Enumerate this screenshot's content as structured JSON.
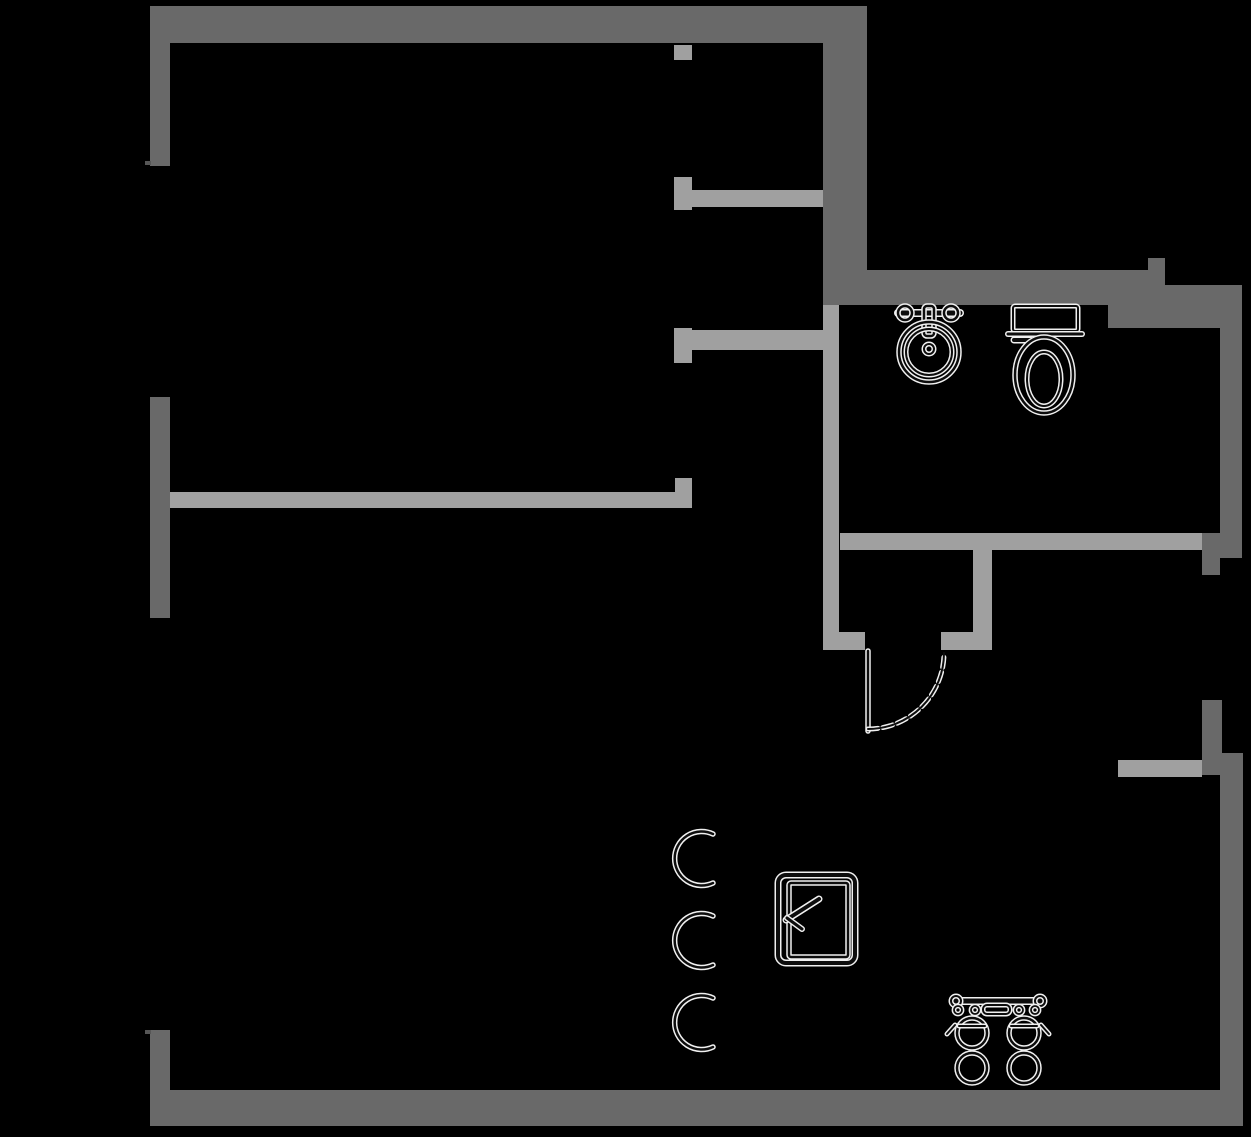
{
  "canvas": {
    "width": 1251,
    "height": 1137,
    "background": "#000000"
  },
  "colors": {
    "wall_dark": "#696969",
    "wall_light": "#a0a0a0",
    "tick": "#565656",
    "fixture_halo": "#f0f0f0",
    "fixture_core": "#0d0d0d"
  },
  "walls": {
    "dark": [
      {
        "name": "wall-top",
        "x": 152,
        "y": 6,
        "w": 715,
        "h": 37
      },
      {
        "name": "wall-left-upper",
        "x": 150,
        "y": 6,
        "w": 20,
        "h": 160
      },
      {
        "name": "wall-left-middle",
        "x": 150,
        "y": 397,
        "w": 20,
        "h": 221
      },
      {
        "name": "wall-left-lower",
        "x": 150,
        "y": 1030,
        "w": 20,
        "h": 96
      },
      {
        "name": "wall-bottom",
        "x": 150,
        "y": 1090,
        "w": 1093,
        "h": 36
      },
      {
        "name": "wall-divider-thick",
        "x": 823,
        "y": 43,
        "w": 44,
        "h": 262
      },
      {
        "name": "wall-bath-top-left",
        "x": 867,
        "y": 270,
        "w": 281,
        "h": 35
      },
      {
        "name": "wall-bath-top-bump",
        "x": 1148,
        "y": 258,
        "w": 17,
        "h": 47
      },
      {
        "name": "wall-bath-top-right",
        "x": 1165,
        "y": 285,
        "w": 77,
        "h": 43
      },
      {
        "name": "wall-bath-top-under",
        "x": 1108,
        "y": 305,
        "w": 57,
        "h": 23
      },
      {
        "name": "wall-right-upper",
        "x": 1220,
        "y": 328,
        "w": 22,
        "h": 230
      },
      {
        "name": "wall-right-corner-block",
        "x": 1202,
        "y": 533,
        "w": 40,
        "h": 25
      },
      {
        "name": "wall-right-corner-tail",
        "x": 1202,
        "y": 558,
        "w": 18,
        "h": 17
      },
      {
        "name": "wall-right-mid-stub",
        "x": 1202,
        "y": 700,
        "w": 20,
        "h": 75
      },
      {
        "name": "wall-right-lower",
        "x": 1220,
        "y": 753,
        "w": 23,
        "h": 373
      }
    ],
    "light": [
      {
        "name": "jamb-top",
        "x": 674,
        "y": 45,
        "w": 18,
        "h": 15
      },
      {
        "name": "jamb-upper",
        "x": 674,
        "y": 177,
        "w": 18,
        "h": 33
      },
      {
        "name": "wall-hall-upper",
        "x": 692,
        "y": 190,
        "w": 131,
        "h": 17
      },
      {
        "name": "jamb-lower",
        "x": 674,
        "y": 328,
        "w": 18,
        "h": 35
      },
      {
        "name": "wall-hall-lower",
        "x": 692,
        "y": 330,
        "w": 131,
        "h": 20
      },
      {
        "name": "wall-mid-horizontal",
        "x": 170,
        "y": 492,
        "w": 522,
        "h": 16
      },
      {
        "name": "wall-mid-endcap",
        "x": 675,
        "y": 478,
        "w": 17,
        "h": 30
      },
      {
        "name": "wall-closet-left",
        "x": 823,
        "y": 305,
        "w": 16,
        "h": 345
      },
      {
        "name": "stub-door-left",
        "x": 823,
        "y": 632,
        "w": 42,
        "h": 18
      },
      {
        "name": "wall-closet-top",
        "x": 840,
        "y": 533,
        "w": 362,
        "h": 17
      },
      {
        "name": "stub-door-right",
        "x": 941,
        "y": 632,
        "w": 51,
        "h": 18
      },
      {
        "name": "wall-door-jamb-column",
        "x": 973,
        "y": 550,
        "w": 19,
        "h": 98
      },
      {
        "name": "wall-right-light",
        "x": 1118,
        "y": 760,
        "w": 84,
        "h": 17
      }
    ],
    "ticks": [
      {
        "name": "wall-end-tick-upper",
        "x": 145,
        "y": 161,
        "w": 6,
        "h": 4
      },
      {
        "name": "wall-end-tick-lower",
        "x": 145,
        "y": 1030,
        "w": 6,
        "h": 4
      }
    ]
  },
  "fixtures": [
    {
      "name": "bathroom-sink-fixture",
      "shapes": [
        {
          "type": "line",
          "x1": 898,
          "y1": 313,
          "x2": 960,
          "y2": 313,
          "w": 5
        },
        {
          "type": "circle",
          "cx": 905,
          "cy": 313,
          "r": 7,
          "w": 2.5
        },
        {
          "type": "circle",
          "cx": 951,
          "cy": 313,
          "r": 7,
          "w": 2.5
        },
        {
          "type": "rect",
          "x": 924,
          "y": 306,
          "wd": 10,
          "h": 30,
          "rx": 3,
          "w": 2.5
        },
        {
          "type": "circle",
          "cx": 929,
          "cy": 352,
          "r": 30,
          "w": 2.5
        },
        {
          "type": "circle",
          "cx": 929,
          "cy": 352,
          "r": 23,
          "w": 2
        },
        {
          "type": "circle",
          "cx": 929,
          "cy": 349,
          "r": 5,
          "w": 2
        }
      ]
    },
    {
      "name": "toilet-fixture",
      "shapes": [
        {
          "type": "rect",
          "x": 1013,
          "y": 306,
          "wd": 65,
          "h": 25,
          "rx": 2,
          "w": 2
        },
        {
          "type": "line",
          "x1": 1008,
          "y1": 334,
          "x2": 1082,
          "y2": 334,
          "w": 3
        },
        {
          "type": "line",
          "x1": 1014,
          "y1": 340,
          "x2": 1030,
          "y2": 340,
          "w": 4
        },
        {
          "type": "ellipse",
          "cx": 1044,
          "cy": 375,
          "rx": 29,
          "ry": 38,
          "w": 2.5
        },
        {
          "type": "ellipse",
          "cx": 1044,
          "cy": 379,
          "rx": 17,
          "ry": 27,
          "w": 2
        }
      ]
    },
    {
      "name": "door-swing",
      "shapes": [
        {
          "type": "line",
          "x1": 868,
          "y1": 651,
          "x2": 868,
          "y2": 731,
          "w": 2.5
        },
        {
          "type": "path",
          "d": "M 868 729 A 76 76 0 0 0 944 653",
          "w": 2,
          "dash": "10 5"
        }
      ]
    },
    {
      "name": "dishwasher-fixture",
      "shapes": [
        {
          "type": "rect",
          "x": 778,
          "y": 875,
          "wd": 77,
          "h": 88,
          "rx": 8,
          "w": 4
        },
        {
          "type": "rect",
          "x": 789,
          "y": 883,
          "wd": 59,
          "h": 74,
          "rx": 2,
          "w": 2.5
        },
        {
          "type": "line",
          "x1": 819,
          "y1": 899,
          "x2": 786,
          "y2": 920,
          "w": 4
        },
        {
          "type": "line",
          "x1": 787,
          "y1": 918,
          "x2": 802,
          "y2": 929,
          "w": 3
        }
      ]
    },
    {
      "name": "stool-arc-top",
      "shapes": [
        {
          "type": "path",
          "d": "M 713 834 A 27 27 0 1 0 713 883",
          "w": 2.5
        }
      ]
    },
    {
      "name": "stool-arc-middle",
      "shapes": [
        {
          "type": "path",
          "d": "M 713 916 A 27 27 0 1 0 713 965",
          "w": 2.5
        }
      ]
    },
    {
      "name": "stool-arc-bottom",
      "shapes": [
        {
          "type": "path",
          "d": "M 713 998 A 27 27 0 1 0 713 1047",
          "w": 2.5
        }
      ]
    },
    {
      "name": "double-basin-fixture",
      "shapes": [
        {
          "type": "line",
          "x1": 953,
          "y1": 1001,
          "x2": 1043,
          "y2": 1001,
          "w": 5
        },
        {
          "type": "circle",
          "cx": 956,
          "cy": 1001,
          "r": 5,
          "w": 2
        },
        {
          "type": "circle",
          "cx": 1040,
          "cy": 1001,
          "r": 5,
          "w": 2
        },
        {
          "type": "rect",
          "x": 983,
          "y": 1005,
          "wd": 27,
          "h": 9,
          "rx": 4,
          "w": 2
        },
        {
          "type": "circle",
          "cx": 958,
          "cy": 1010,
          "r": 4,
          "w": 1.8
        },
        {
          "type": "circle",
          "cx": 975,
          "cy": 1010,
          "r": 4,
          "w": 1.8
        },
        {
          "type": "circle",
          "cx": 1019,
          "cy": 1010,
          "r": 4,
          "w": 1.8
        },
        {
          "type": "circle",
          "cx": 1035,
          "cy": 1010,
          "r": 4,
          "w": 1.8
        },
        {
          "type": "circle",
          "cx": 972,
          "cy": 1033,
          "r": 15,
          "w": 2.5
        },
        {
          "type": "line",
          "x1": 959,
          "y1": 1026,
          "x2": 985,
          "y2": 1026,
          "w": 2
        },
        {
          "type": "circle",
          "cx": 1024,
          "cy": 1033,
          "r": 15,
          "w": 2.5
        },
        {
          "type": "line",
          "x1": 1011,
          "y1": 1026,
          "x2": 1037,
          "y2": 1026,
          "w": 2
        },
        {
          "type": "line",
          "x1": 955,
          "y1": 1025,
          "x2": 947,
          "y2": 1034,
          "w": 2
        },
        {
          "type": "line",
          "x1": 1041,
          "y1": 1025,
          "x2": 1049,
          "y2": 1034,
          "w": 2
        },
        {
          "type": "circle",
          "cx": 972,
          "cy": 1068,
          "r": 15,
          "w": 2.5
        },
        {
          "type": "circle",
          "cx": 1024,
          "cy": 1068,
          "r": 15,
          "w": 2.5
        }
      ]
    }
  ]
}
